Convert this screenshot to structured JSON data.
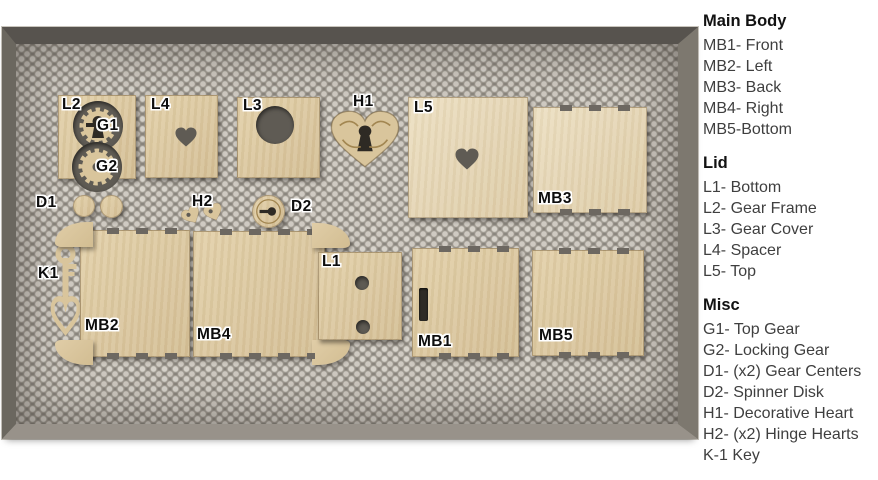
{
  "legend": {
    "sections": [
      {
        "title": "Main Body",
        "items": [
          "MB1- Front",
          "MB2- Left",
          "MB3- Back",
          "MB4- Right",
          "MB5-Bottom"
        ]
      },
      {
        "title": "Lid",
        "items": [
          "L1- Bottom",
          "L2- Gear Frame",
          "L3- Gear Cover",
          "L4- Spacer",
          "L5- Top"
        ]
      },
      {
        "title": "Misc",
        "items": [
          "G1- Top Gear",
          "G2- Locking Gear",
          "D1- (x2) Gear Centers",
          "D2- Spinner Disk",
          "H1- Decorative Heart",
          "H2- (x2) Hinge Hearts",
          "K-1 Key"
        ]
      }
    ]
  },
  "colors": {
    "wood": "#d9c59c",
    "wood_light": "#e8dabb",
    "hole_dark": "#5f5b54",
    "cut_black": "#2e2a24",
    "engrave": "#a28651",
    "frame_metal": "#6b675f",
    "label_text": "#0d0d0d"
  },
  "bed": {
    "pieces": [
      {
        "id": "L2",
        "x": 42,
        "y": 51,
        "w": 78,
        "h": 84,
        "cutouts": [
          {
            "type": "gear",
            "x": 14,
            "y": 5,
            "s": 50,
            "center": "keyhole"
          },
          {
            "type": "gear",
            "x": 13,
            "y": 46,
            "s": 50,
            "center": "hole"
          }
        ]
      },
      {
        "id": "L4",
        "x": 129,
        "y": 51,
        "w": 73,
        "h": 83,
        "cutouts": [
          {
            "type": "heart-hole",
            "x": 29,
            "y": 31,
            "w": 22,
            "h": 20
          }
        ]
      },
      {
        "id": "L3",
        "x": 221,
        "y": 53,
        "w": 83,
        "h": 81,
        "cutouts": [
          {
            "type": "circle-hole",
            "x": 18,
            "y": 8,
            "s": 38
          }
        ]
      },
      {
        "id": "H1",
        "kind": "heart",
        "x": 314,
        "y": 66,
        "w": 70,
        "h": 58,
        "detail": "h1"
      },
      {
        "id": "L5",
        "x": 392,
        "y": 53,
        "w": 120,
        "h": 121,
        "tone": "light",
        "cutouts": [
          {
            "type": "heart-hole",
            "x": 46,
            "y": 50,
            "w": 24,
            "h": 22
          }
        ]
      },
      {
        "id": "MB3",
        "x": 517,
        "y": 63,
        "w": 114,
        "h": 106,
        "tabbed": true,
        "tone": "light"
      },
      {
        "id": "D1a",
        "kind": "circle",
        "x": 57,
        "y": 151,
        "w": 22,
        "h": 22
      },
      {
        "id": "D1b",
        "kind": "circle",
        "x": 84,
        "y": 151,
        "w": 23,
        "h": 23
      },
      {
        "id": "H2a",
        "kind": "heart",
        "x": 166,
        "y": 163,
        "w": 19,
        "h": 17,
        "rot": -30,
        "hole": true
      },
      {
        "id": "H2b",
        "kind": "heart",
        "x": 188,
        "y": 160,
        "w": 19,
        "h": 17,
        "rot": -20,
        "hole": true
      },
      {
        "id": "D2",
        "kind": "circle",
        "x": 236,
        "y": 151,
        "w": 33,
        "h": 33,
        "overlay": "d2"
      },
      {
        "id": "K1",
        "kind": "key",
        "x": 36,
        "y": 201,
        "w": 27,
        "h": 88
      },
      {
        "id": "MB2",
        "x": 64,
        "y": 186,
        "w": 110,
        "h": 127,
        "tabbed": true,
        "fancy": "left"
      },
      {
        "id": "MB4",
        "x": 177,
        "y": 187,
        "w": 132,
        "h": 126,
        "tabbed": true,
        "fancy": "right"
      },
      {
        "id": "L1",
        "x": 302,
        "y": 208,
        "w": 84,
        "h": 88,
        "cutouts": [
          {
            "type": "circle-hole",
            "x": 36,
            "y": 23,
            "s": 14
          },
          {
            "type": "circle-hole",
            "x": 37,
            "y": 67,
            "s": 14
          }
        ]
      },
      {
        "id": "MB1",
        "x": 396,
        "y": 204,
        "w": 107,
        "h": 109,
        "tabbed": true,
        "cutouts": [
          {
            "type": "slot",
            "x": 6,
            "y": 39,
            "w": 9,
            "h": 33
          }
        ]
      },
      {
        "id": "MB5",
        "x": 516,
        "y": 206,
        "w": 112,
        "h": 106,
        "tabbed": true
      }
    ],
    "labels": [
      {
        "text": "L2",
        "x": 46,
        "y": 52
      },
      {
        "text": "G1",
        "x": 81,
        "y": 73
      },
      {
        "text": "G2",
        "x": 80,
        "y": 114
      },
      {
        "text": "L4",
        "x": 135,
        "y": 52
      },
      {
        "text": "L3",
        "x": 227,
        "y": 53
      },
      {
        "text": "H1",
        "x": 337,
        "y": 49
      },
      {
        "text": "L5",
        "x": 398,
        "y": 55
      },
      {
        "text": "MB3",
        "x": 522,
        "y": 146
      },
      {
        "text": "D1",
        "x": 20,
        "y": 150
      },
      {
        "text": "H2",
        "x": 176,
        "y": 149
      },
      {
        "text": "D2",
        "x": 275,
        "y": 154
      },
      {
        "text": "K1",
        "x": 22,
        "y": 221
      },
      {
        "text": "MB2",
        "x": 69,
        "y": 273
      },
      {
        "text": "MB4",
        "x": 181,
        "y": 282
      },
      {
        "text": "L1",
        "x": 306,
        "y": 209
      },
      {
        "text": "MB1",
        "x": 402,
        "y": 289
      },
      {
        "text": "MB5",
        "x": 523,
        "y": 283
      }
    ]
  }
}
